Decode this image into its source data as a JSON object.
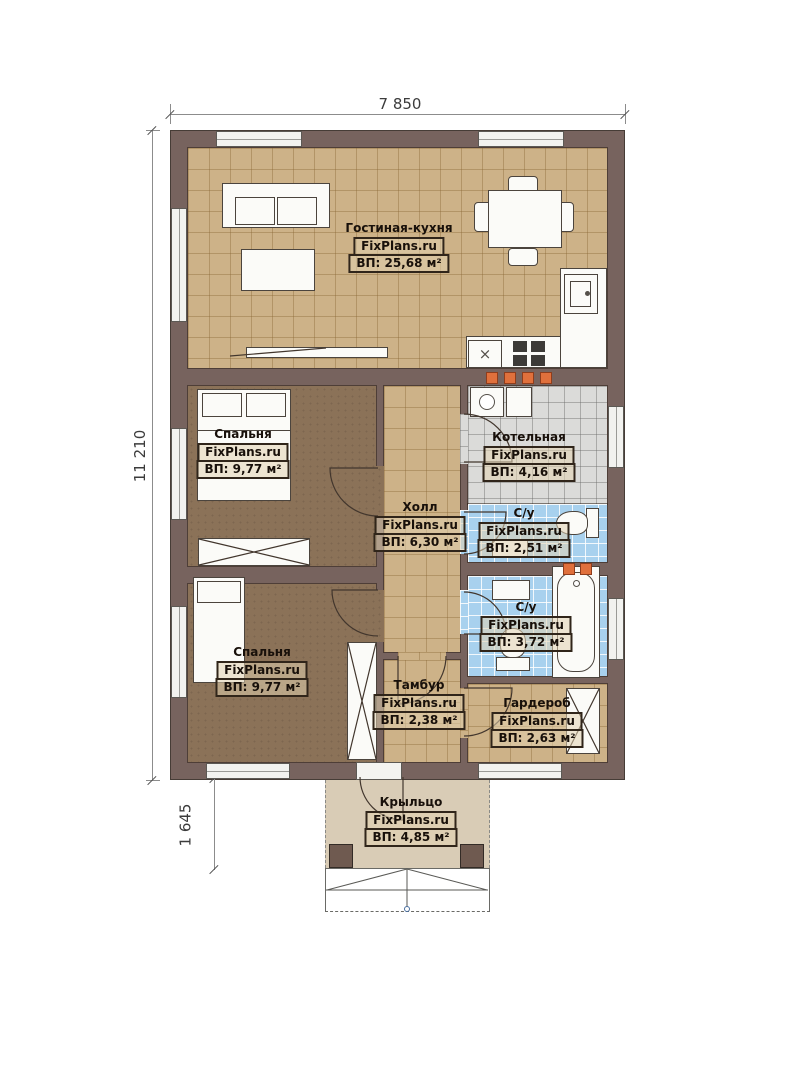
{
  "watermark": "FixPlans.ru",
  "dimensions": {
    "width_top": "7 850",
    "height_left": "11 210",
    "porch_height": "1 645"
  },
  "rooms": [
    {
      "id": "living-kitchen",
      "name": "Гостиная-кухня",
      "area": "ВП: 25,68 м²"
    },
    {
      "id": "bedroom-1",
      "name": "Спальня",
      "area": "ВП: 9,77 м²"
    },
    {
      "id": "boiler-room",
      "name": "Котельная",
      "area": "ВП: 4,16 м²"
    },
    {
      "id": "hall",
      "name": "Холл",
      "area": "ВП: 6,30 м²"
    },
    {
      "id": "bathroom-1",
      "name": "С/у",
      "area": "ВП: 2,51 м²"
    },
    {
      "id": "bathroom-2",
      "name": "С/у",
      "area": "ВП: 3,72 м²"
    },
    {
      "id": "bedroom-2",
      "name": "Спальня",
      "area": "ВП: 9,77 м²"
    },
    {
      "id": "vestibule",
      "name": "Тамбур",
      "area": "ВП: 2,38 м²"
    },
    {
      "id": "wardrobe",
      "name": "Гардероб",
      "area": "ВП: 2,63 м²"
    },
    {
      "id": "porch",
      "name": "Крыльцо",
      "area": "ВП: 4,85 м²"
    }
  ],
  "symbols": {
    "dishwasher_mark": "×"
  },
  "colors": {
    "wall": "#77635e",
    "tile_tan": "#cdb288",
    "tile_gray": "#dbdbd9",
    "tile_blue": "#a8d1ee",
    "wood_floor": "#8b7258",
    "porch_floor": "#d9ccb6",
    "accent_orange": "#e0703c"
  }
}
